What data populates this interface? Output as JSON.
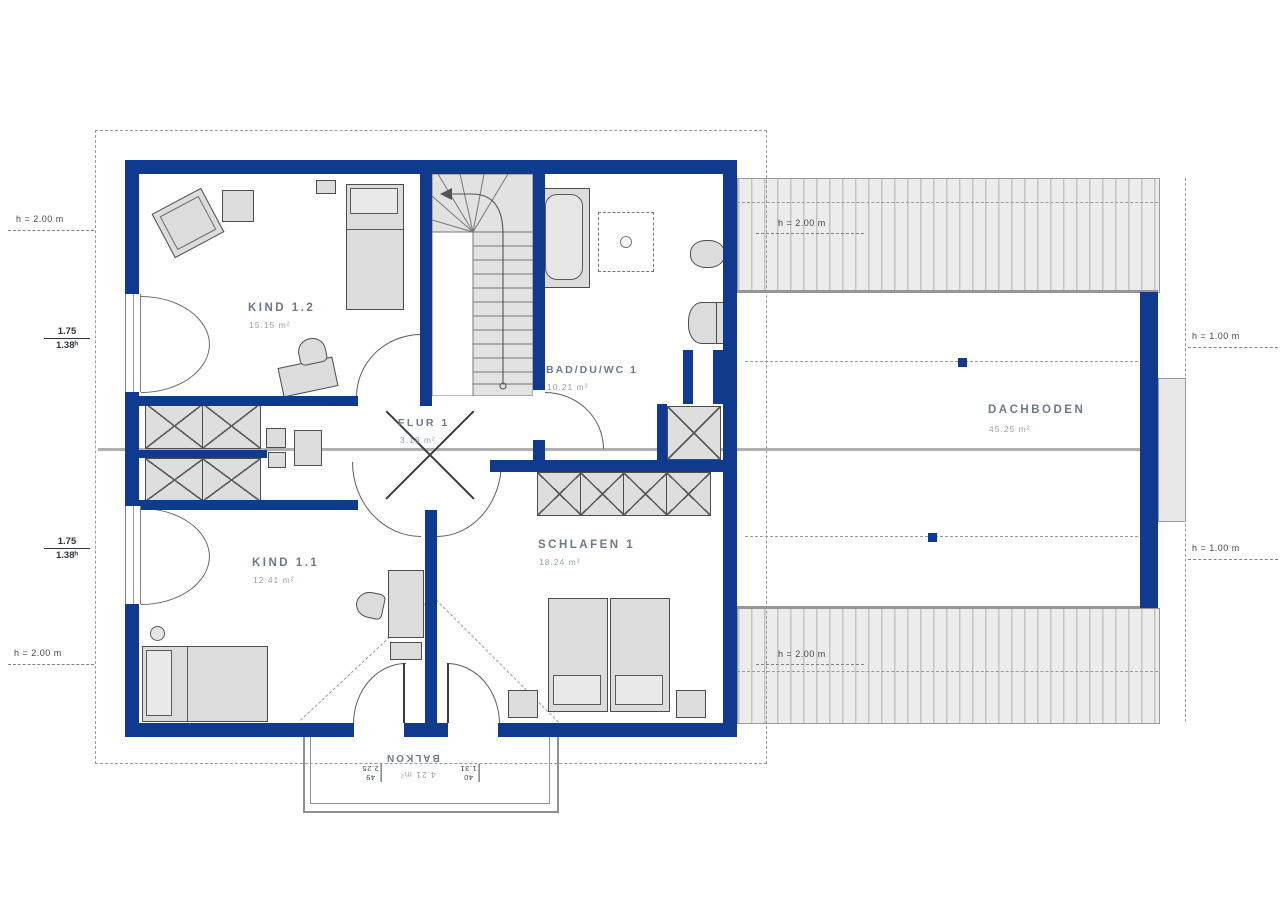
{
  "plan": {
    "title": "Dachgeschoss Grundriss",
    "rooms": [
      {
        "id": "kind-1-2",
        "label": "KIND 1.2",
        "area": "15.15 m²"
      },
      {
        "id": "bad-du-wc-1",
        "label": "BAD/DU/WC 1",
        "area": "10.21 m²"
      },
      {
        "id": "flur-1",
        "label": "FLUR 1",
        "area": "3.18 m²"
      },
      {
        "id": "kind-1-1",
        "label": "KIND 1.1",
        "area": "12.41 m²"
      },
      {
        "id": "schlafen-1",
        "label": "SCHLAFEN 1",
        "area": "18.24 m²"
      },
      {
        "id": "dachboden",
        "label": "DACHBODEN",
        "area": "45.25 m²"
      },
      {
        "id": "balkon",
        "label": "BALKON",
        "area": "4.21 m²"
      }
    ],
    "dims": {
      "h_left_top": "h = 2.00 m",
      "h_left_bottom": "h = 2.00 m",
      "h_attic_top": "h = 2.00 m",
      "h_attic_bottom": "h = 2.00 m",
      "h_right_top": "h = 1.00 m",
      "h_right_bottom": "h = 1.00 m",
      "knee_upper": {
        "num": "1.75",
        "den": "1.38ʰ"
      },
      "knee_lower": {
        "num": "1.75",
        "den": "1.38ʰ"
      },
      "balkon": {
        "left_small": "49",
        "left_val": "2.25",
        "right_small": "40",
        "right_val": "1.31"
      }
    },
    "colors": {
      "wall": "#0f3a8e",
      "furniture": "#dcdcdc",
      "hatch_line": "#c3c3c3",
      "label": "#6d7986"
    }
  }
}
